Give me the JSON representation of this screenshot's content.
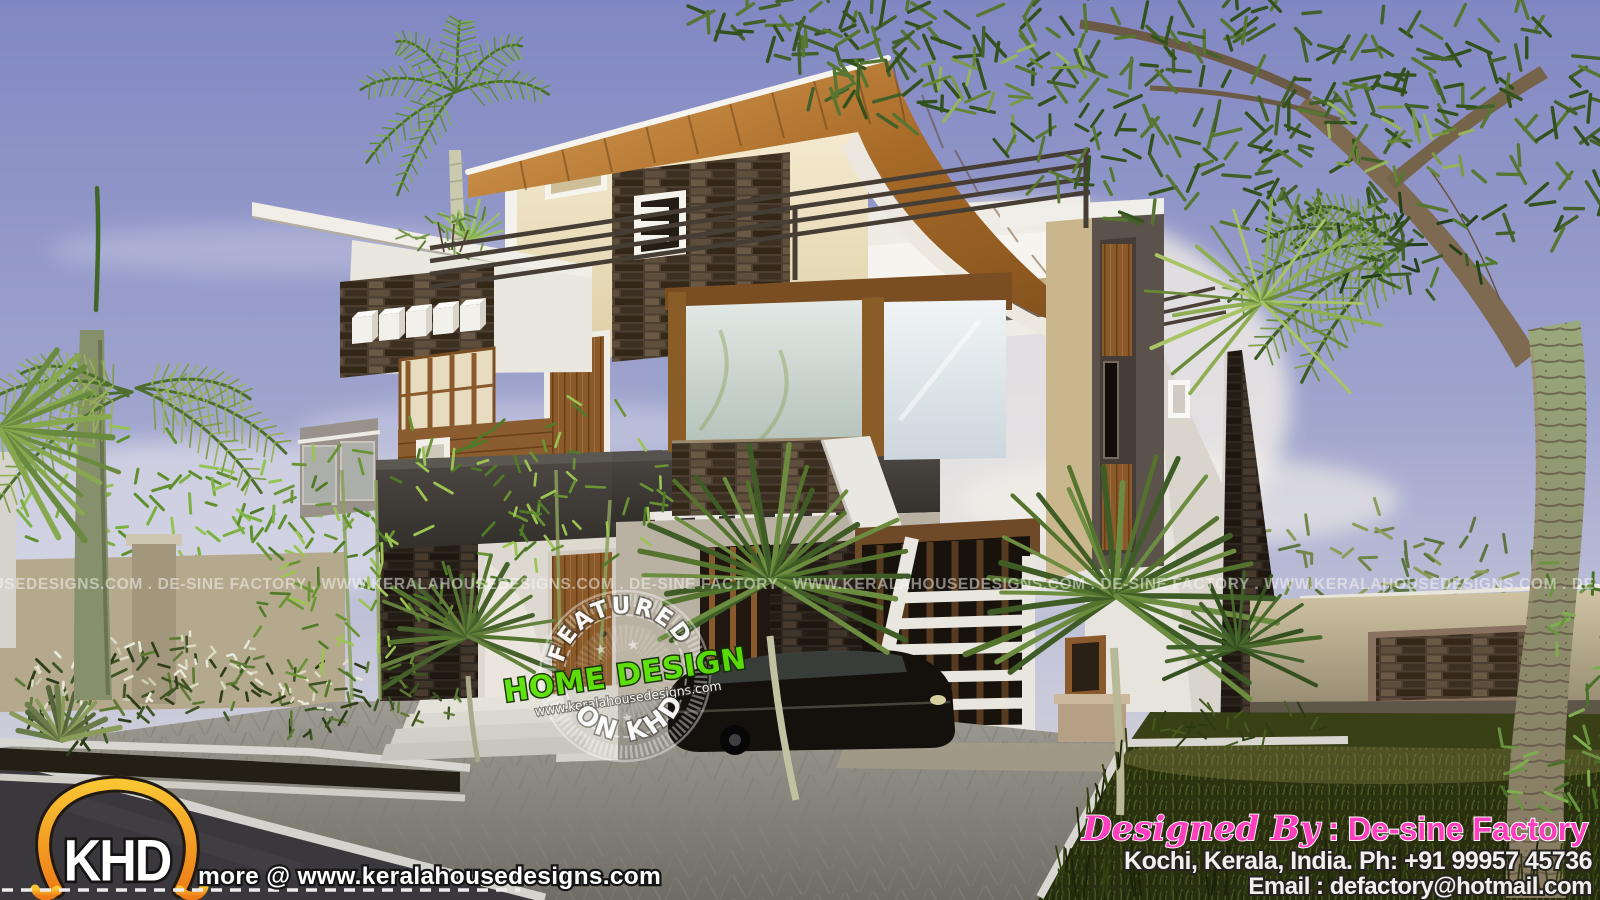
{
  "scene": {
    "type": "3d-architectural-rendering",
    "subject": "Modern contemporary two-storey house with curved wooden roof, stacked-stone cladding, steel terrace railings, palm trees, paved driveway and lawn at dusk",
    "colors": {
      "sky_top": "#8287c3",
      "sky_horizon": "#dcd6d8",
      "wall_cream": "#f0e4c2",
      "wall_white": "#eceae4",
      "roof_wood": "#b97c33",
      "stone_brown": "#4c3f31",
      "stone_dark": "#2e2720",
      "fascia_charcoal": "#3f3a36",
      "railing_dark": "#463d35",
      "glass_reflection": "#ccd6d2",
      "grass_dark": "#2b3110",
      "paver_gray": "#93908a",
      "road_asphalt": "#3a383c",
      "brand_orange": "#f49a1e",
      "brand_pink": "#ff3fbe",
      "brand_green": "#58e000"
    }
  },
  "watermark": {
    "text": "WWW.KERALAHOUSEDESIGNS.COM . DE-SINE FACTORY . WWW.KERALAHOUSEDESIGNS.COM . DE-SINE FACTORY . WWW.KERALAHOUSEDESIGNS.COM . DE-SINE FACTORY . WWW.KERALAHOUSEDESIGNS.COM . DE-SINE FACTORY . WWW.KERALAHOUSEDESIGNS.COM"
  },
  "badge": {
    "top_arc": "FEATURED",
    "stars_top": "★ ★",
    "title": "HOME DESIGN",
    "url": "www.keralahousedesigns.com",
    "stars_bottom": "★ ★ ★",
    "bottom_arc": "ON KHD"
  },
  "khd_logo": {
    "brand": "KHD",
    "tagline": "more @ www.keralahousedesigns.com"
  },
  "credits": {
    "designed_by": "Designed By",
    "designer": " : De-sine Factory",
    "location_phone": "Kochi, Kerala, India. Ph: +91 99957 45736",
    "email": "Email : defactory@hotmail.com"
  }
}
